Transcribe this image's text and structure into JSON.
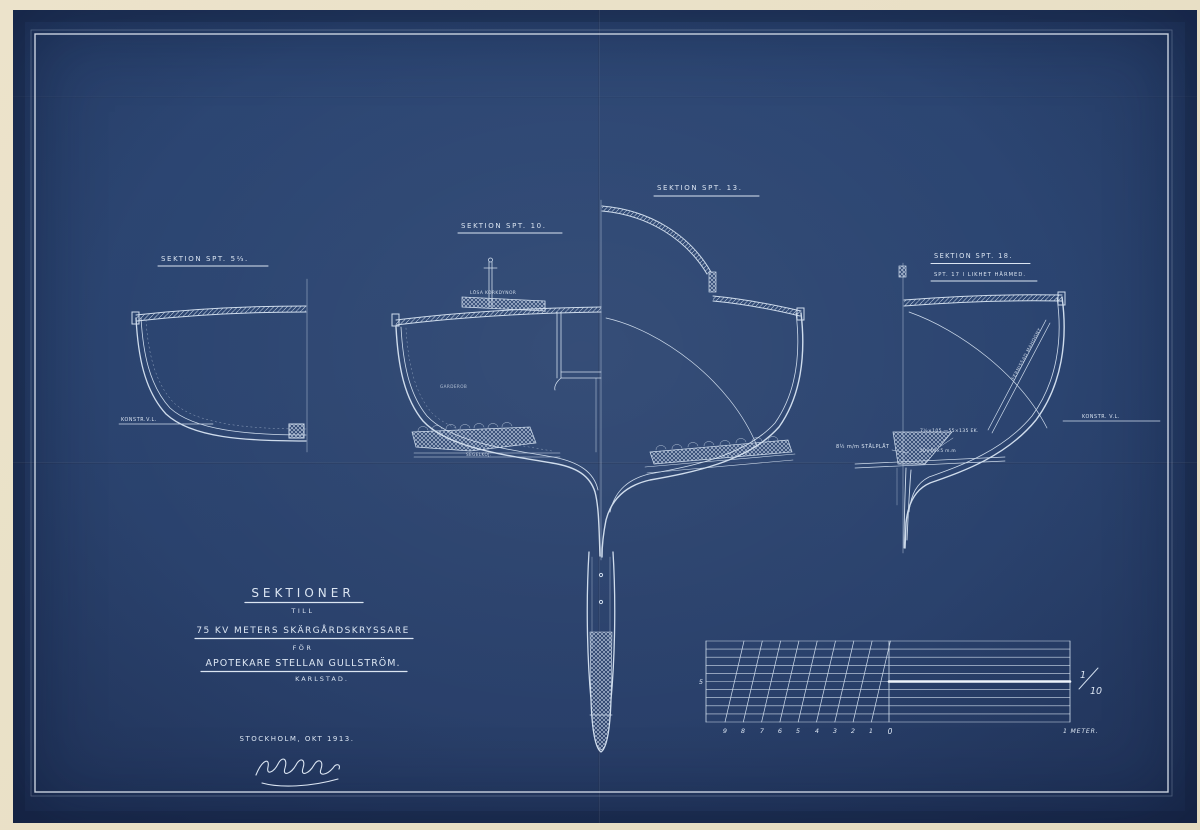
{
  "colors": {
    "paper": "#e9e0c6",
    "blueprint_blue": "#2b4470",
    "line": "#cfdcec",
    "bright_line": "#eaf1f9"
  },
  "sections": {
    "s1": {
      "label": "SEKTION SPT. 5⅔."
    },
    "s2": {
      "label": "SEKTION SPT. 10."
    },
    "s3": {
      "label": "SEKTION SPT. 13."
    },
    "s4": {
      "label": "SEKTION SPT. 18.",
      "sublabel": "SPT. 17 I LIKHET HÄRMED."
    }
  },
  "annotations": {
    "konstr_vl_left": "KONSTR.V.L.",
    "konstr_vl_right": "KONSTR. V.L.",
    "cork": "LÖSA KORKDYNOR",
    "berth": "SEGELKOJ.",
    "wardrobe": "GARDEROB",
    "steel_plate": "8½ m/m STÅLPLÅT",
    "oak_dimensions": "7½×105 —55×135  EK.",
    "bolt_dimensions": "50×40×5 m.m",
    "mahogany": "FERNISSAD MAHOGNY"
  },
  "title_block": {
    "title": "SEKTIONER",
    "till": "TILL",
    "vessel": "75 KV METERS SKÄRGÅRDSKRYSSARE",
    "for_word": "FÖR",
    "owner": "APOTEKARE STELLAN GULLSTRÖM.",
    "city": "KARLSTAD.",
    "place_date": "STOCKHOLM, OKT 1913."
  },
  "scale_bar": {
    "numbers": [
      "9",
      "8",
      "7",
      "6",
      "5",
      "4",
      "3",
      "2",
      "1",
      "0"
    ],
    "mid_label": "5",
    "ratio_numerator": "1",
    "ratio_denominator": "10",
    "unit": "1 METER."
  }
}
